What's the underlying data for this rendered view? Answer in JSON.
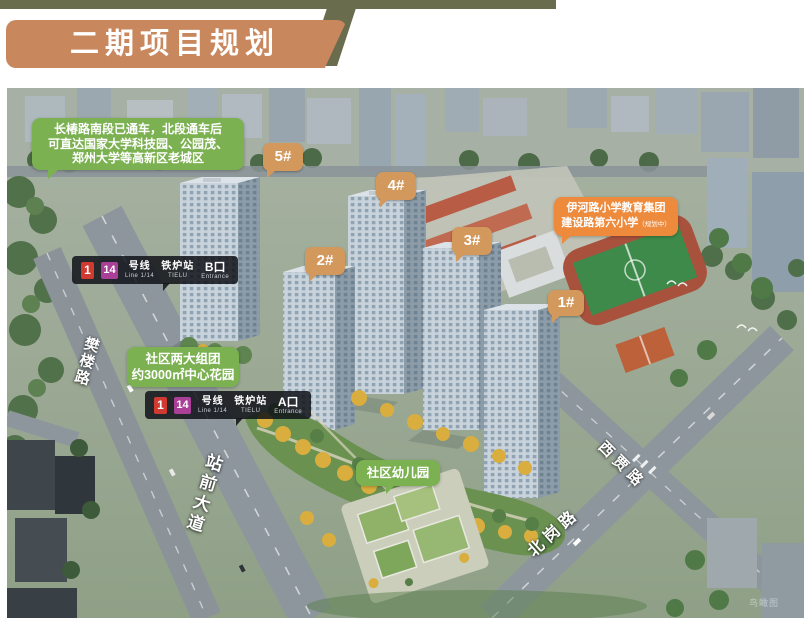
{
  "page": {
    "title_banner": "二期项目规划",
    "caption": "鸟瞰图"
  },
  "notes": {
    "traffic": {
      "line1": "长椿路南段已通车，北段通车后",
      "line2": "可直达国家大学科技园、公园茂、",
      "line3": "郑州大学等高新区老城区"
    },
    "community": {
      "line1": "社区两大组团",
      "line2": "约3000㎡中心花园"
    },
    "school": {
      "line1": "伊河路小学教育集团",
      "line2": "建设路第六小学",
      "line2_suffix": "（规划中）"
    },
    "kindergarten": "社区幼儿园"
  },
  "metro": {
    "line1_badge": "1",
    "line14_badge": "14",
    "line_label": "号线",
    "line_sub": "Line 1/14",
    "station_label": "铁炉站",
    "station_sub": "TIELU",
    "exit_b": {
      "label": "B口",
      "sub": "Entrance"
    },
    "exit_a": {
      "label": "A口",
      "sub": "Entrance"
    }
  },
  "building_badges": [
    {
      "label": "5#"
    },
    {
      "label": "4#"
    },
    {
      "label": "2#"
    },
    {
      "label": "3#"
    },
    {
      "label": "1#"
    }
  ],
  "roads": {
    "fanlou": "樊楼路",
    "zhanqian": "站前大道",
    "xijia": "西贾路",
    "beigang": "北岗路"
  },
  "colors": {
    "banner_orange": "#C8875C",
    "olive": "#6A6C4E",
    "note_green": "#7CB152",
    "school_orange": "#ED8A3C",
    "badge_tan": "#D2985C",
    "metro_bg": "#15181E",
    "line1_red": "#D03A30",
    "line14_purple": "#A93F96"
  }
}
